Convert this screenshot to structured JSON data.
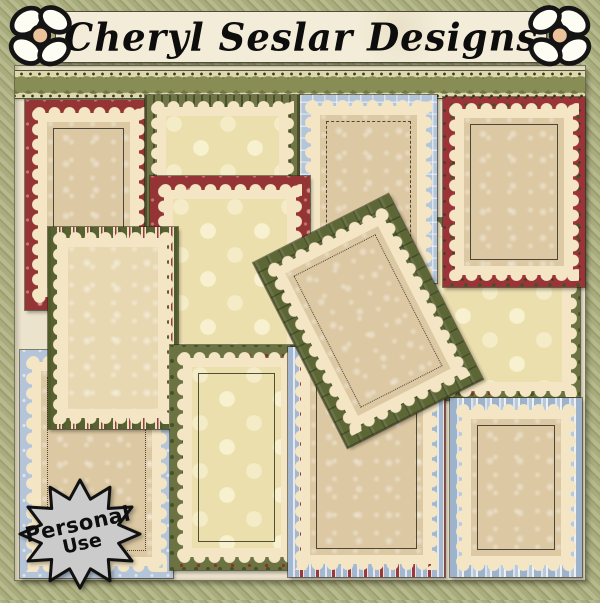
{
  "header": {
    "title": "Cheryl Seslar Designs",
    "left_flower": "daisy-flower",
    "right_flower": "daisy-flower"
  },
  "ribbon": {
    "style": "olive-braid-with-dotted-edges"
  },
  "badge": {
    "line1": "Personal",
    "line2": "Use",
    "shape": "starburst",
    "fill": "#cbcbcb"
  },
  "palette": {
    "background_olive_stripe_light": "#b7ba8e",
    "background_olive_stripe_dark": "#9da06e",
    "mat_cream": "#ebe3cb",
    "banner_cream": "#f2ecd8",
    "scallop_cream": "#f4e6c4",
    "red": "#943434",
    "olive_green": "#6f7544",
    "dark_green_plaid": "#5d6736",
    "light_blue": "#b2c5da",
    "tan_inner": "#dcc8a2",
    "polka_cream": "#ecdfae",
    "badge_gray": "#cbcbcb",
    "text_black": "#0d0d0d"
  },
  "frames": [
    {
      "id": "backing-polka-holly",
      "border": "green-holly",
      "inner": "cream-polka-dots"
    },
    {
      "id": "red-snowflake-frame-top-left",
      "border": "red-snowflake",
      "inner": "tan-snowflake"
    },
    {
      "id": "olive-pinstripe-frame",
      "border": "olive-pinstripe",
      "inner": "cream-polka-dots"
    },
    {
      "id": "blue-plaid-frame",
      "border": "blue-plaid",
      "inner": "tan-snowflake"
    },
    {
      "id": "red-holly-frame",
      "border": "red-holly",
      "inner": "tan-snowflake"
    },
    {
      "id": "red-snowflake-frame-middle",
      "border": "red-snowflake",
      "inner": "cream-polka-dots"
    },
    {
      "id": "blue-snowflake-frame",
      "border": "blue-snowflake",
      "inner": "tan-snowflake"
    },
    {
      "id": "green-candy-stripe-frame",
      "border": "green-candy-stripe",
      "inner": "cream-snowflake"
    },
    {
      "id": "green-holly-frame",
      "border": "green-holly",
      "inner": "cream-polka-dots"
    },
    {
      "id": "blue-red-stripe-frame",
      "border": "blue-red-stripe",
      "inner": "tan-snowflake"
    },
    {
      "id": "blue-stripe-frame",
      "border": "blue-stripe",
      "inner": "tan-snowflake"
    },
    {
      "id": "green-plaid-frame-rotated",
      "border": "green-plaid",
      "inner": "tan-snowflake",
      "rotation_deg": -27
    }
  ]
}
